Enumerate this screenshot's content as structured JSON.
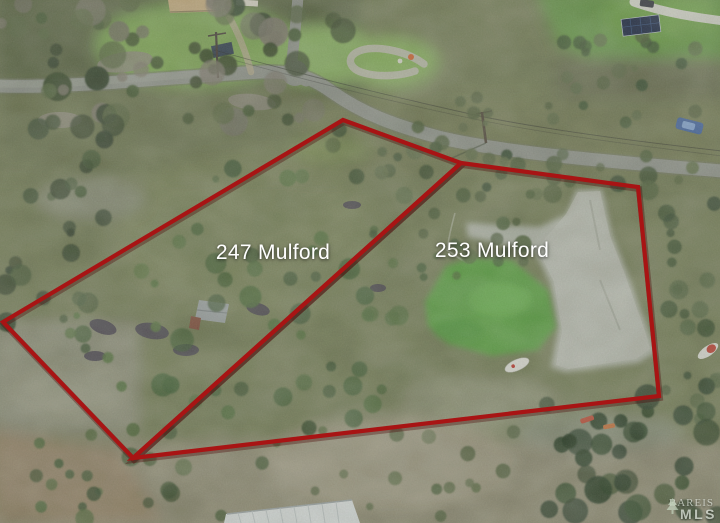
{
  "photo": {
    "description": "Aerial drone view of two vacant land parcels outlined in red beside a winding road"
  },
  "annotations": {
    "boundary_color": "#a81414",
    "label_color": "#ffffff",
    "parcels": [
      {
        "id": "247",
        "label": "247 Mulford"
      },
      {
        "id": "253",
        "label": "253 Mulford"
      }
    ]
  },
  "watermark": {
    "line1": "BAREIS",
    "line2": "MLS"
  }
}
